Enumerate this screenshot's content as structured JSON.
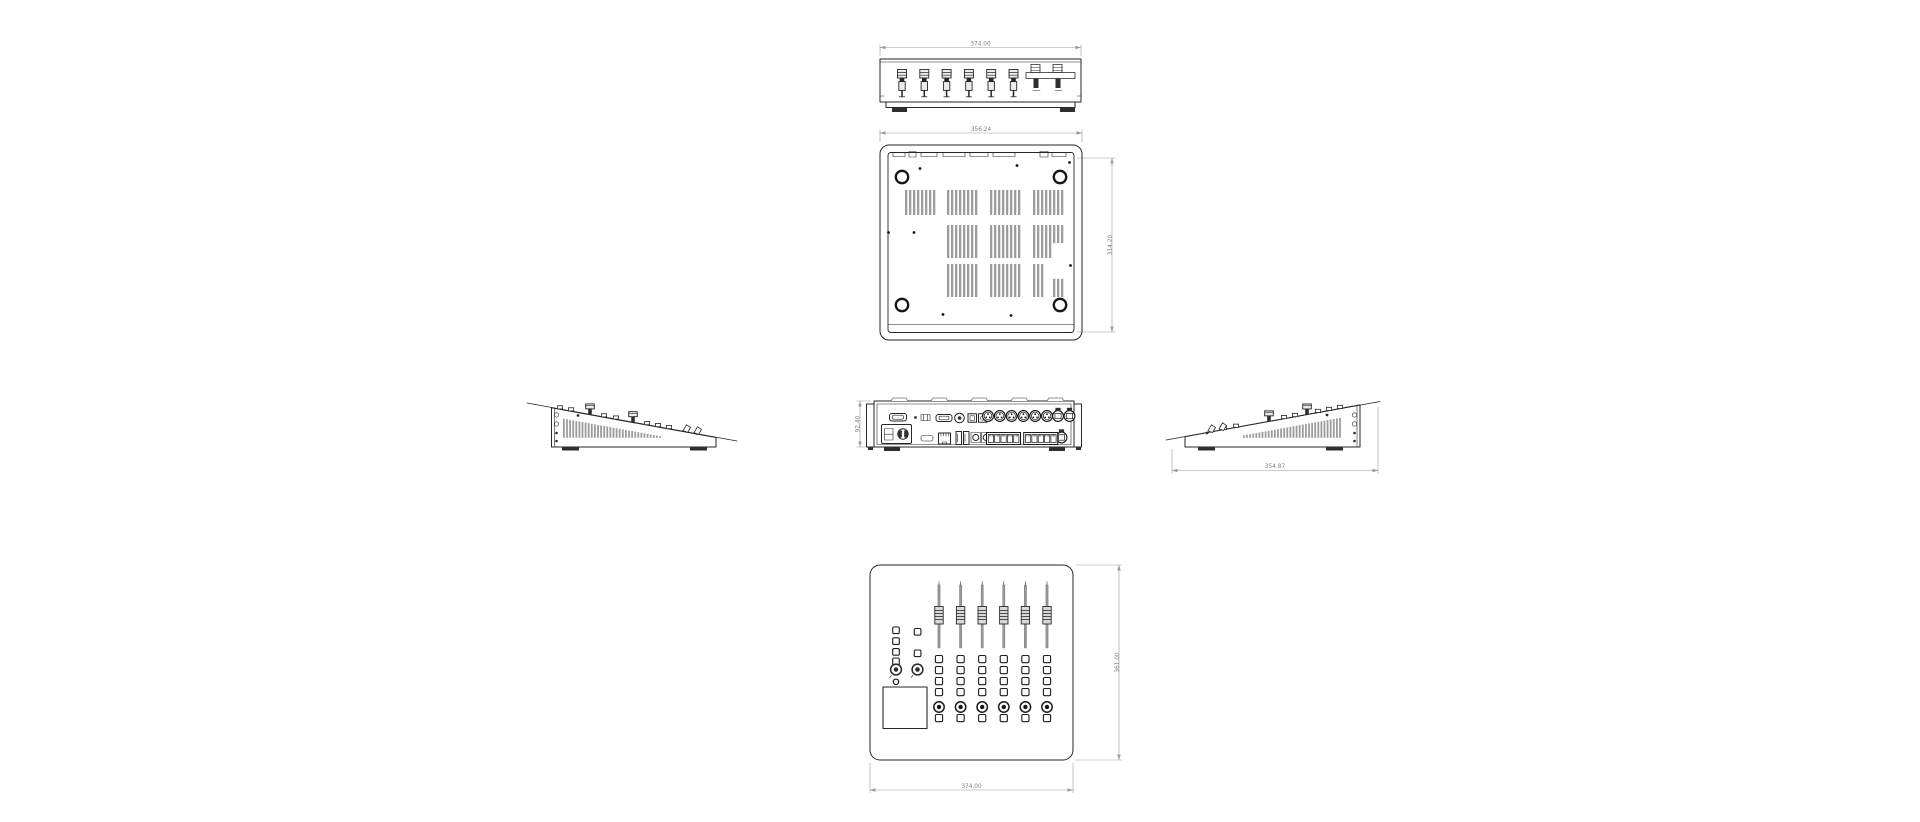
{
  "style": {
    "background": "#ffffff",
    "ink": "#262626",
    "dim_line": "#9a9a9a",
    "dim_text": "#7d7d7d",
    "vent": "#9c9c9c",
    "fader_fill": "#ececec"
  },
  "views": {
    "front_elevation": {
      "dim_width": "374.00"
    },
    "bottom": {
      "dim_width": "356.24",
      "dim_depth": "314.20"
    },
    "rear": {
      "dim_height": "92.40"
    },
    "left_side": {},
    "right_side": {
      "dim_depth": "354.87"
    },
    "top_panel": {
      "dim_width": "374.00",
      "dim_depth": "361.00"
    }
  },
  "drawing": {
    "front_fader_knobs": 6,
    "top_fader_channels": 6,
    "channel_button_rows": 4,
    "left_button_column_count": 4,
    "rear_xlr_connectors": 6,
    "rear_ethercon_connectors": 3,
    "rear_rj45_groups": 2,
    "rear_rj45_jacks_per_group": 5,
    "bottom_feet": 4,
    "bottom_vent_rows": 3
  }
}
